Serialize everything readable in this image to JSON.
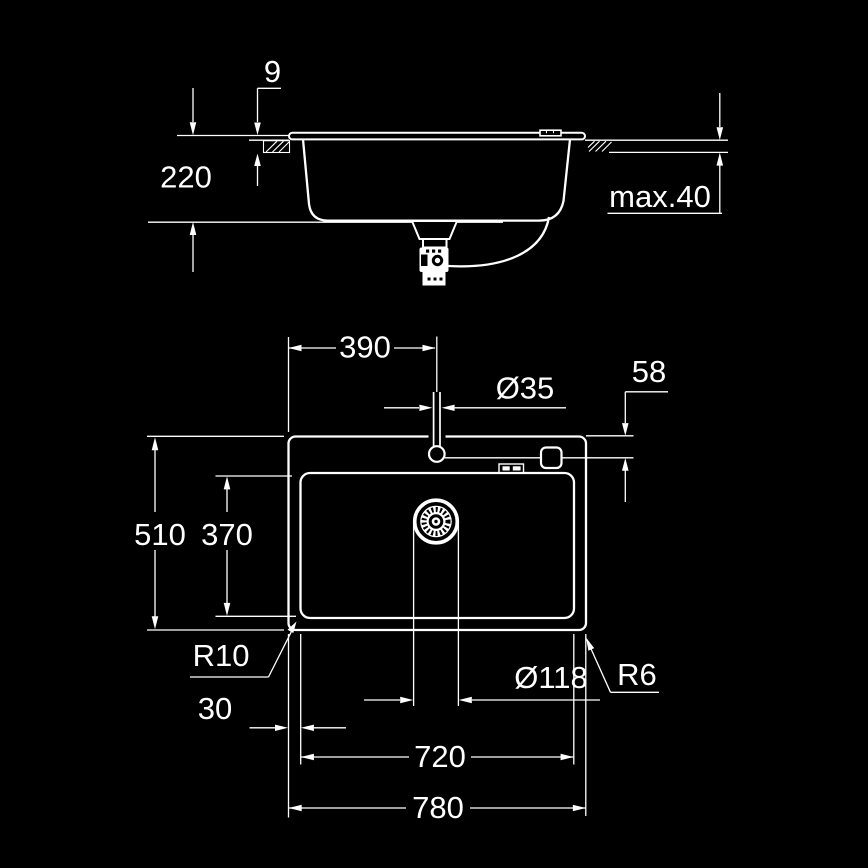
{
  "drawing_type": "kitchen sink installation dimension drawing",
  "colors": {
    "background": "#000000",
    "line": "#ffffff"
  },
  "side_view": {
    "labels": {
      "rim_height": "9",
      "bowl_depth": "220",
      "worktop_thickness": "max.40"
    }
  },
  "plan_view": {
    "labels": {
      "tap_offset_x": "390",
      "tap_hole_diameter": "Ø35",
      "tap_offset_y": "58",
      "overall_depth": "510",
      "bowl_inner_depth": "370",
      "bowl_corner_radius": "R10",
      "edge_margin": "30",
      "bowl_inner_width": "720",
      "overall_width": "780",
      "drain_diameter": "Ø118",
      "outer_corner_radius": "R6"
    }
  }
}
